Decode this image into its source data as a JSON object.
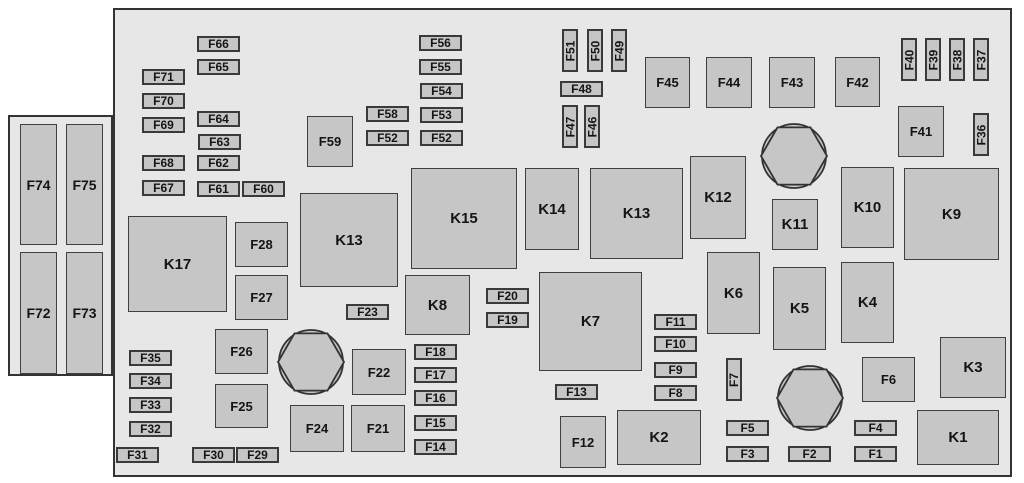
{
  "diagram": {
    "type": "fuse-box-diagram",
    "colors": {
      "background": "#ffffff",
      "panel_fill": "#e7e7e7",
      "box_fill": "#c6c6c6",
      "line": "#333333",
      "text": "#151515"
    },
    "main_panel": {
      "x": 113,
      "y": 8,
      "w": 899,
      "h": 469
    },
    "side_panel": {
      "x": 8,
      "y": 115,
      "w": 105,
      "h": 261
    },
    "connector_slots": [
      {
        "label": "F74",
        "x": 20,
        "y": 124,
        "w": 37,
        "h": 121
      },
      {
        "label": "F75",
        "x": 66,
        "y": 124,
        "w": 37,
        "h": 121
      },
      {
        "label": "F72",
        "x": 20,
        "y": 252,
        "w": 37,
        "h": 122
      },
      {
        "label": "F73",
        "x": 66,
        "y": 252,
        "w": 37,
        "h": 122
      }
    ],
    "fuses_h": [
      {
        "label": "F66",
        "x": 197,
        "y": 36
      },
      {
        "label": "F65",
        "x": 197,
        "y": 59
      },
      {
        "label": "F71",
        "x": 142,
        "y": 69
      },
      {
        "label": "F70",
        "x": 142,
        "y": 93
      },
      {
        "label": "F69",
        "x": 142,
        "y": 117
      },
      {
        "label": "F64",
        "x": 197,
        "y": 111
      },
      {
        "label": "F63",
        "x": 198,
        "y": 134
      },
      {
        "label": "F68",
        "x": 142,
        "y": 155
      },
      {
        "label": "F62",
        "x": 197,
        "y": 155
      },
      {
        "label": "F67",
        "x": 142,
        "y": 180
      },
      {
        "label": "F61",
        "x": 197,
        "y": 181
      },
      {
        "label": "F60",
        "x": 242,
        "y": 181
      },
      {
        "label": "F56",
        "x": 419,
        "y": 35
      },
      {
        "label": "F55",
        "x": 419,
        "y": 59
      },
      {
        "label": "F54",
        "x": 420,
        "y": 83
      },
      {
        "label": "F58",
        "x": 366,
        "y": 106
      },
      {
        "label": "F53",
        "x": 420,
        "y": 107
      },
      {
        "label": "F52",
        "x": 366,
        "y": 130
      },
      {
        "label": "F52",
        "x": 420,
        "y": 130
      },
      {
        "label": "F48",
        "x": 560,
        "y": 81
      },
      {
        "label": "F23",
        "x": 346,
        "y": 304
      },
      {
        "label": "F20",
        "x": 486,
        "y": 288
      },
      {
        "label": "F19",
        "x": 486,
        "y": 312
      },
      {
        "label": "F35",
        "x": 129,
        "y": 350
      },
      {
        "label": "F34",
        "x": 129,
        "y": 373
      },
      {
        "label": "F33",
        "x": 129,
        "y": 397
      },
      {
        "label": "F32",
        "x": 129,
        "y": 421
      },
      {
        "label": "F31",
        "x": 116,
        "y": 447
      },
      {
        "label": "F30",
        "x": 192,
        "y": 447
      },
      {
        "label": "F29",
        "x": 236,
        "y": 447
      },
      {
        "label": "F18",
        "x": 414,
        "y": 344
      },
      {
        "label": "F17",
        "x": 414,
        "y": 367
      },
      {
        "label": "F16",
        "x": 414,
        "y": 390
      },
      {
        "label": "F15",
        "x": 414,
        "y": 415
      },
      {
        "label": "F14",
        "x": 414,
        "y": 439
      },
      {
        "label": "F13",
        "x": 555,
        "y": 384
      },
      {
        "label": "F11",
        "x": 654,
        "y": 314
      },
      {
        "label": "F10",
        "x": 654,
        "y": 336
      },
      {
        "label": "F9",
        "x": 654,
        "y": 362
      },
      {
        "label": "F8",
        "x": 654,
        "y": 385
      },
      {
        "label": "F5",
        "x": 726,
        "y": 420
      },
      {
        "label": "F3",
        "x": 726,
        "y": 446
      },
      {
        "label": "F2",
        "x": 788,
        "y": 446
      },
      {
        "label": "F4",
        "x": 854,
        "y": 420
      },
      {
        "label": "F1",
        "x": 854,
        "y": 446
      }
    ],
    "fuses_v": [
      {
        "label": "F51",
        "x": 562,
        "y": 29
      },
      {
        "label": "F50",
        "x": 587,
        "y": 29
      },
      {
        "label": "F49",
        "x": 611,
        "y": 29
      },
      {
        "label": "F47",
        "x": 562,
        "y": 105
      },
      {
        "label": "F46",
        "x": 584,
        "y": 105
      },
      {
        "label": "F40",
        "x": 901,
        "y": 38
      },
      {
        "label": "F39",
        "x": 925,
        "y": 38
      },
      {
        "label": "F38",
        "x": 949,
        "y": 38
      },
      {
        "label": "F37",
        "x": 973,
        "y": 38
      },
      {
        "label": "F36",
        "x": 973,
        "y": 113
      },
      {
        "label": "F7",
        "x": 726,
        "y": 358
      }
    ],
    "fuse_boxes": [
      {
        "label": "F59",
        "x": 307,
        "y": 116,
        "w": 46,
        "h": 51
      },
      {
        "label": "F45",
        "x": 645,
        "y": 57,
        "w": 45,
        "h": 51
      },
      {
        "label": "F44",
        "x": 706,
        "y": 57,
        "w": 46,
        "h": 51
      },
      {
        "label": "F43",
        "x": 769,
        "y": 57,
        "w": 46,
        "h": 51
      },
      {
        "label": "F42",
        "x": 835,
        "y": 57,
        "w": 45,
        "h": 50
      },
      {
        "label": "F41",
        "x": 898,
        "y": 106,
        "w": 46,
        "h": 51
      },
      {
        "label": "F28",
        "x": 235,
        "y": 222,
        "w": 53,
        "h": 45
      },
      {
        "label": "F27",
        "x": 235,
        "y": 275,
        "w": 53,
        "h": 45
      },
      {
        "label": "F26",
        "x": 215,
        "y": 329,
        "w": 53,
        "h": 45
      },
      {
        "label": "F25",
        "x": 215,
        "y": 384,
        "w": 53,
        "h": 44
      },
      {
        "label": "F24",
        "x": 290,
        "y": 405,
        "w": 54,
        "h": 47
      },
      {
        "label": "F22",
        "x": 352,
        "y": 349,
        "w": 54,
        "h": 46
      },
      {
        "label": "F21",
        "x": 351,
        "y": 405,
        "w": 54,
        "h": 47
      },
      {
        "label": "F12",
        "x": 560,
        "y": 416,
        "w": 46,
        "h": 52
      },
      {
        "label": "F6",
        "x": 862,
        "y": 357,
        "w": 53,
        "h": 45
      }
    ],
    "relays": [
      {
        "label": "K17",
        "x": 128,
        "y": 216,
        "w": 99,
        "h": 96
      },
      {
        "label": "K13",
        "x": 300,
        "y": 193,
        "w": 98,
        "h": 94
      },
      {
        "label": "K15",
        "x": 411,
        "y": 168,
        "w": 106,
        "h": 101
      },
      {
        "label": "K14",
        "x": 525,
        "y": 168,
        "w": 54,
        "h": 82
      },
      {
        "label": "K13",
        "x": 590,
        "y": 168,
        "w": 93,
        "h": 91
      },
      {
        "label": "K12",
        "x": 690,
        "y": 156,
        "w": 56,
        "h": 83
      },
      {
        "label": "K11",
        "x": 772,
        "y": 199,
        "w": 46,
        "h": 51
      },
      {
        "label": "K10",
        "x": 841,
        "y": 167,
        "w": 53,
        "h": 81
      },
      {
        "label": "K9",
        "x": 904,
        "y": 168,
        "w": 95,
        "h": 92
      },
      {
        "label": "K8",
        "x": 405,
        "y": 275,
        "w": 65,
        "h": 60
      },
      {
        "label": "K7",
        "x": 539,
        "y": 272,
        "w": 103,
        "h": 99
      },
      {
        "label": "K6",
        "x": 707,
        "y": 252,
        "w": 53,
        "h": 82
      },
      {
        "label": "K5",
        "x": 773,
        "y": 267,
        "w": 53,
        "h": 83
      },
      {
        "label": "K4",
        "x": 841,
        "y": 262,
        "w": 53,
        "h": 81
      },
      {
        "label": "K3",
        "x": 940,
        "y": 337,
        "w": 66,
        "h": 61
      },
      {
        "label": "K2",
        "x": 617,
        "y": 410,
        "w": 84,
        "h": 55
      },
      {
        "label": "K1",
        "x": 917,
        "y": 410,
        "w": 82,
        "h": 55
      }
    ],
    "bolts": [
      {
        "cx": 794,
        "cy": 156,
        "r": 33
      },
      {
        "cx": 311,
        "cy": 362,
        "r": 33
      },
      {
        "cx": 810,
        "cy": 398,
        "r": 33
      }
    ]
  }
}
